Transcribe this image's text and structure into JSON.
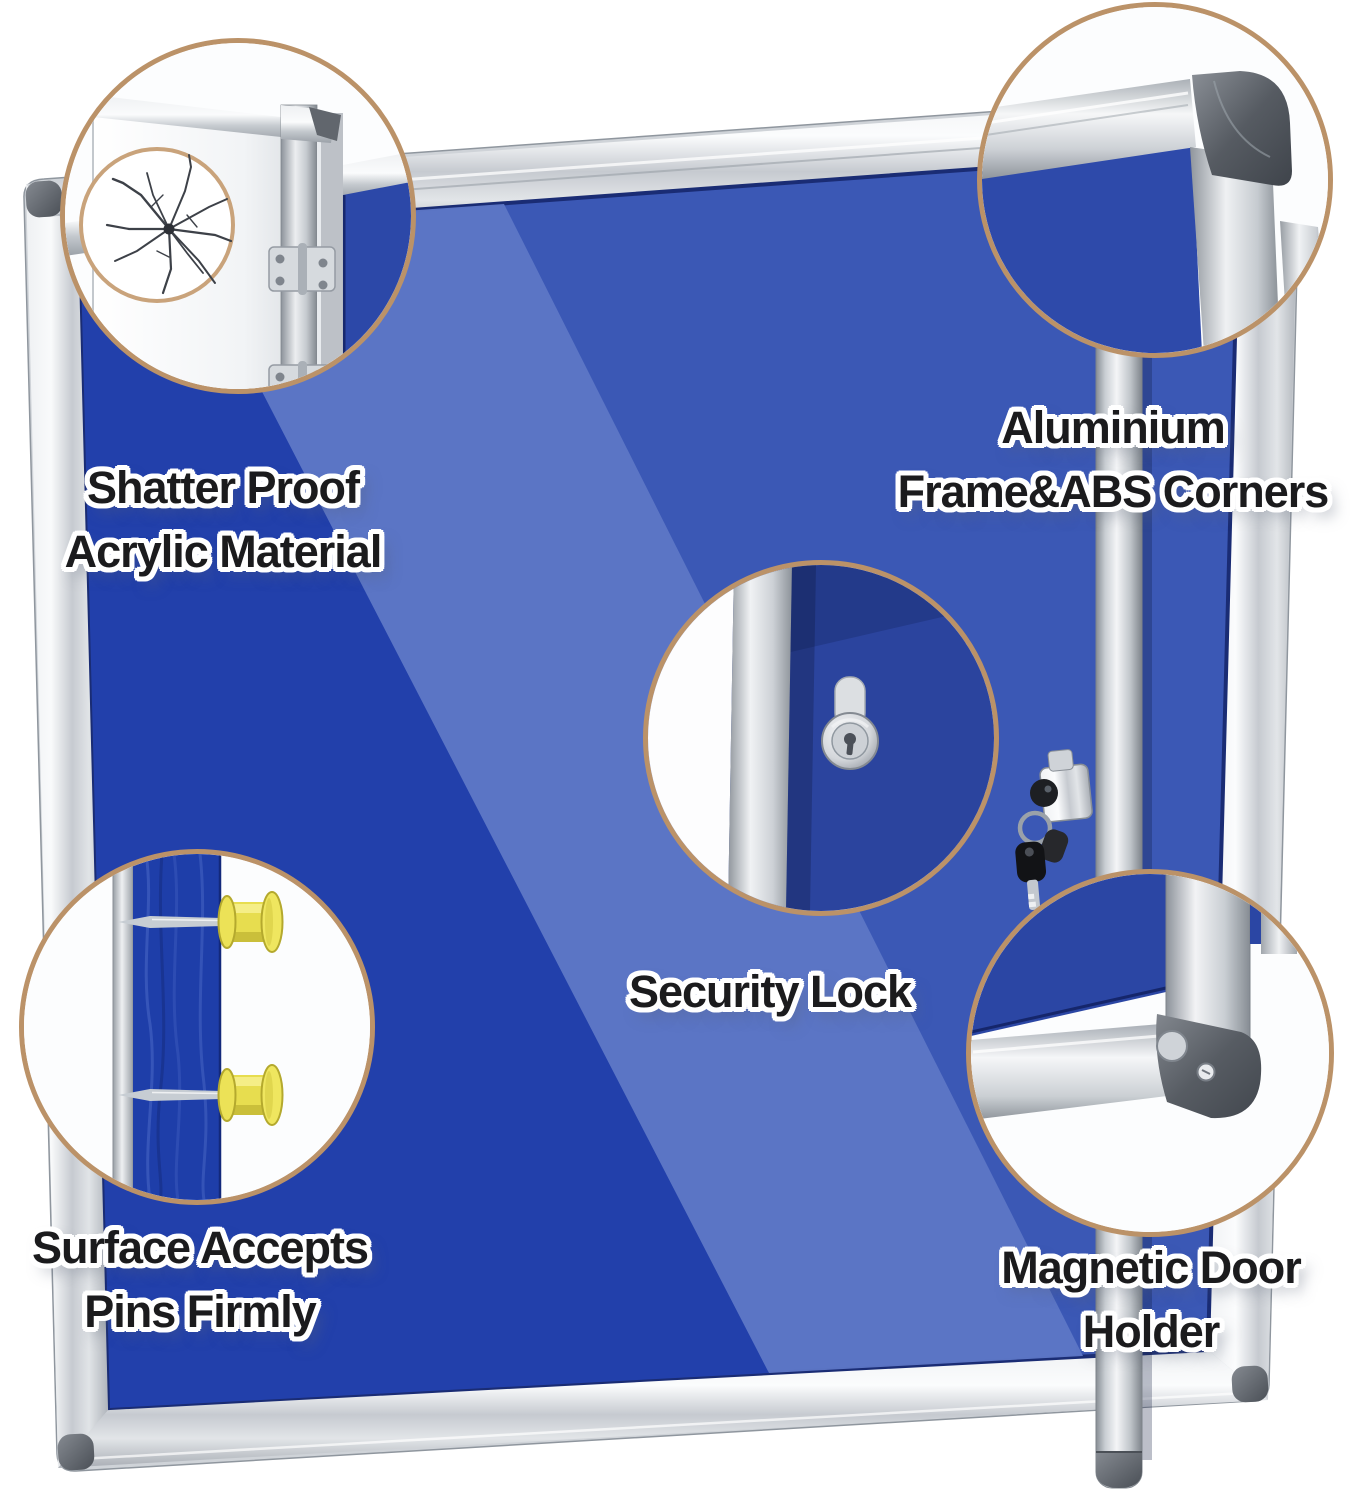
{
  "callouts": [
    {
      "id": "shatter-proof-acrylic",
      "label": "Shatter Proof\nAcrylic Material",
      "icon": "cracked-acrylic-door-icon"
    },
    {
      "id": "aluminium-frame-abs-corners",
      "label": "Aluminium\nFrame&ABS Corners",
      "icon": "aluminium-corner-icon"
    },
    {
      "id": "security-lock",
      "label": "Security Lock",
      "icon": "lock-cylinder-icon"
    },
    {
      "id": "surface-accepts-pins",
      "label": "Surface Accepts\nPins Firmly",
      "icon": "push-pins-icon"
    },
    {
      "id": "magnetic-door-holder",
      "label": "Magnetic Door\nHolder",
      "icon": "magnetic-corner-icon"
    }
  ],
  "colors": {
    "felt_dark": "#2240ab",
    "felt_mid": "#3b58b5",
    "felt_light": "#5d77c6",
    "frame_silver_light": "#f4f5f7",
    "frame_silver": "#c6cad0",
    "frame_silver_dark": "#9aa0a7",
    "abs_corner_gray": "#565b62",
    "circle_ring_tan": "#bb9268",
    "pin_yellow": "#ece257",
    "label_ink": "#1b1b1d",
    "label_outline": "#ffffff",
    "background": "#ffffff"
  }
}
